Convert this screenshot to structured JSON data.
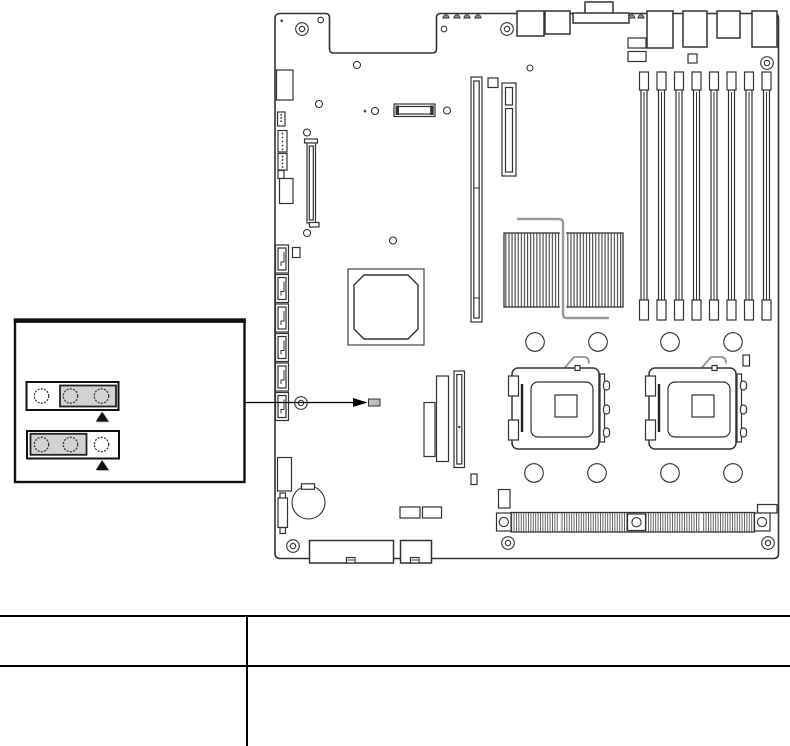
{
  "colors": {
    "background": "#ffffff",
    "line": "#333333",
    "callout_border": "#111111",
    "jumper_cap_fill": "#d2d2d2",
    "jumper_pad_fill": "#bdbdbd",
    "heat_pipe": "#9a9a9a",
    "arrow": "#000000",
    "triangle": "#111111",
    "triangle_shadow": "#9a9a9a"
  },
  "callout": {
    "blocks": [
      {
        "pins": 3,
        "cap_over_pins": "2-3",
        "marker": "up-triangle"
      },
      {
        "pins": 3,
        "cap_over_pins": "1-2",
        "marker": "up-triangle"
      }
    ]
  },
  "board": {
    "dimm_slots": 8,
    "cpu_sockets": 2,
    "sata_ports": 6,
    "mounting_holes": 7,
    "rear_io_ports": 6
  },
  "table": {
    "rows": [
      {
        "col1": "",
        "col2": ""
      },
      {
        "col1": "",
        "col2": ""
      }
    ]
  }
}
